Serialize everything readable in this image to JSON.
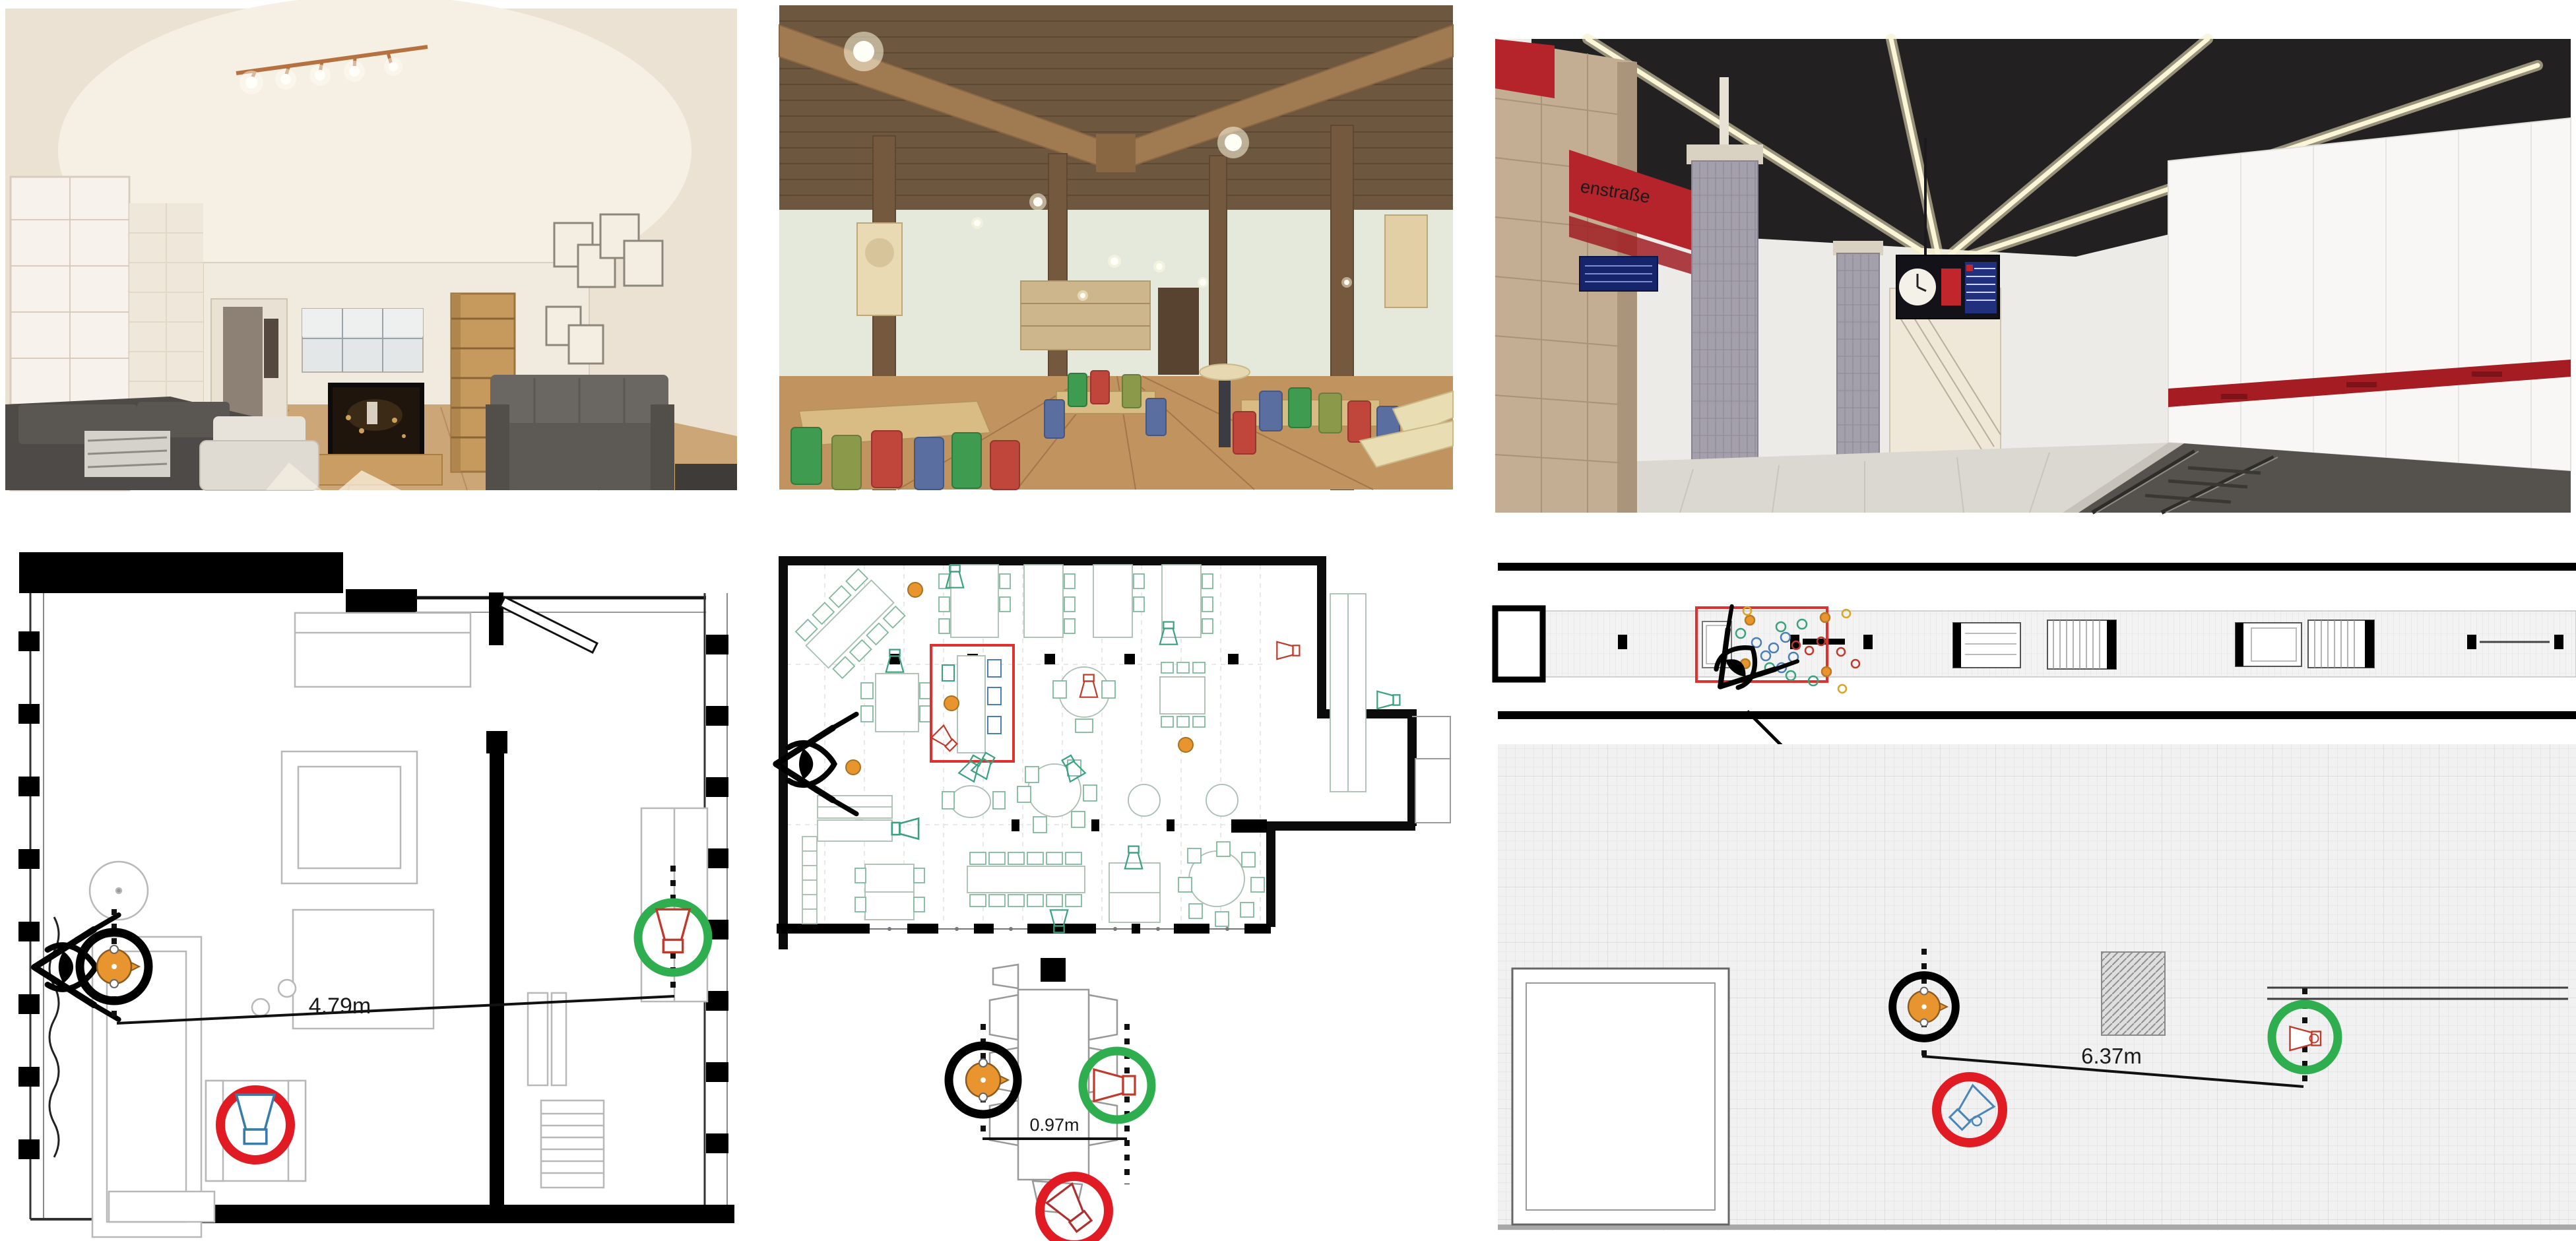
{
  "labels": {
    "living_room_distance": "4.79m",
    "restaurant_distance": "0.97m",
    "subway_distance": "6.37m",
    "subway_sign": "enstraße"
  },
  "colors": {
    "listener_orange": "#E8952F",
    "target_ring_green": "#2EAE4E",
    "occluded_ring_red": "#E01B24",
    "speaker_outline_red": "#C0392B",
    "speaker_outline_blue": "#3A7CA8",
    "zoom_highlight_red": "#E03131"
  },
  "icons": {
    "viewer": "eye-icon",
    "listener": "listener-icon",
    "loudspeaker": "speaker-icon",
    "zoom_region": "zoom-highlight-rect"
  },
  "panels": {
    "top_row": [
      "living-room-render",
      "restaurant-render",
      "subway-render"
    ],
    "bottom_row": [
      "living-room-floorplan",
      "restaurant-floorplan",
      "subway-floorplan"
    ]
  }
}
